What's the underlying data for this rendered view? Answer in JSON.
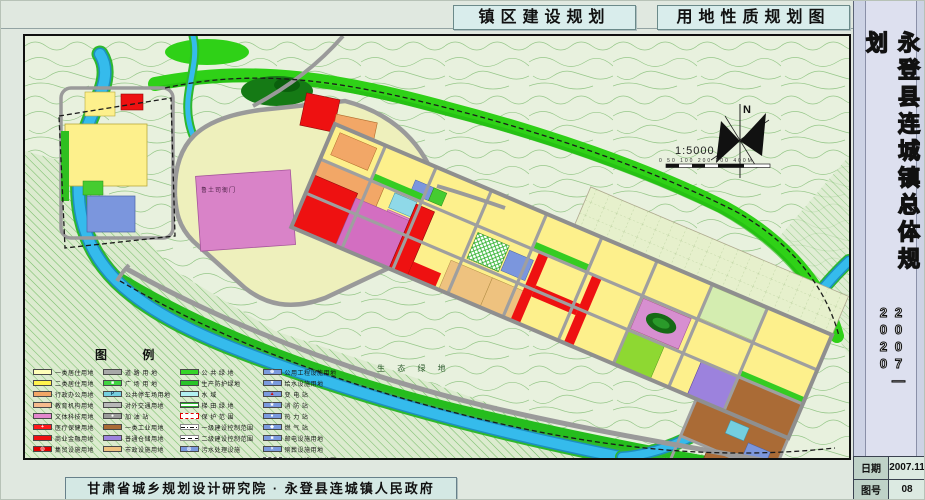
{
  "titles": {
    "left": "镇区建设规划",
    "right": "用地性质规划图"
  },
  "sidebar": {
    "title_vertical": "永登县连城镇总体规划",
    "period": "2007—2020",
    "date_label": "日期",
    "date_value": "2007.11",
    "sheet_label": "图号",
    "sheet_value": "08"
  },
  "footer": {
    "attribution": "甘肃省城乡规划设计研究院 · 永登县连城镇人民政府"
  },
  "map": {
    "north_label": "N",
    "scale_text": "1:5000",
    "scale_ticks": "0 50 100 200 300 400M",
    "labels": {
      "heritage": "鲁土司衙门",
      "eco_green": "生 态 绿 地"
    },
    "legend": {
      "title": "图  例",
      "columns": [
        {
          "items": [
            {
              "label": "一类居住用地",
              "color": "#ffffb8"
            },
            {
              "label": "二类居住用地",
              "color": "#fff34d"
            },
            {
              "label": "行政办公用地",
              "color": "#f2a767"
            },
            {
              "label": "教育机构用地",
              "color": "#f6bb8d"
            },
            {
              "label": "文体科技用地",
              "color": "#e387cd"
            },
            {
              "label": "医疗保健用地",
              "color": "#ff1a1a",
              "glyph": "+",
              "glyphColor": "#ffffff"
            },
            {
              "label": "商业金融用地",
              "color": "#ee1111"
            },
            {
              "label": "集贸设施用地",
              "color": "#e00000",
              "glyph": "◎",
              "glyphColor": "#ffffff"
            }
          ]
        },
        {
          "items": [
            {
              "label": "道 路 用 地",
              "color": "#a8a8a8"
            },
            {
              "label": "广 场 用 地",
              "color": "#3fd43f",
              "glyph": "■",
              "glyphColor": "#ffffff"
            },
            {
              "label": "公共停车场用地",
              "color": "#74cfe0",
              "glyph": "P",
              "glyphColor": "#103a5a"
            },
            {
              "label": "对外交通用地",
              "color": "#b8b8b8"
            },
            {
              "label": "加 油 站",
              "color": "#9a9a9a",
              "glyph": "●",
              "glyphColor": "#ffffff"
            },
            {
              "label": "一类工业用地",
              "color": "#aa6b36"
            },
            {
              "label": "普通仓储用地",
              "color": "#9c82dd"
            },
            {
              "label": "市政设施用地",
              "color": "#eec27f"
            }
          ]
        },
        {
          "items": [
            {
              "label": "公 共 绿 地",
              "color": "#35d527"
            },
            {
              "label": "生产防护绿地",
              "color": "#28c428"
            },
            {
              "label": "水    域",
              "color": "#b2f0f2"
            },
            {
              "label": "梯 田 绿 地",
              "color": "#ffffff",
              "style": "lines-green"
            },
            {
              "label": "保 护 范 围",
              "color": "#ffffff",
              "style": "dashed-red"
            },
            {
              "label": "一级建设控制范围",
              "color": "#ffffff",
              "style": "dash-dot"
            },
            {
              "label": "二级建设控制范围",
              "color": "#ffffff",
              "style": "dashed-black"
            },
            {
              "label": "污水处理设施",
              "color": "#7b9ade",
              "glyph": "◎",
              "glyphColor": "#ffffff"
            }
          ]
        },
        {
          "items": [
            {
              "label": "公用工程设施用地",
              "color": "#7b9ade",
              "glyph": "⊕",
              "glyphColor": "#ffffff"
            },
            {
              "label": "给水设施用地",
              "color": "#7b9ade",
              "glyph": "▼",
              "glyphColor": "#ffffff"
            },
            {
              "label": "变 电 站",
              "color": "#7b9ade",
              "glyph": "▲",
              "glyphColor": "#d01010"
            },
            {
              "label": "消 防 站",
              "color": "#7b9ade",
              "glyph": "★",
              "glyphColor": "#ffffff"
            },
            {
              "label": "热 力 站",
              "color": "#7b9ade",
              "glyph": "●",
              "glyphColor": "#ffffff"
            },
            {
              "label": "燃 气 站",
              "color": "#7b9ade",
              "glyph": "◆",
              "glyphColor": "#ffffff"
            },
            {
              "label": "邮电设施用地",
              "color": "#7b9ade",
              "glyph": "■",
              "glyphColor": "#ffffff"
            },
            {
              "label": "殡葬设施用地",
              "color": "#7b9ade",
              "glyph": "×",
              "glyphColor": "#ffffff"
            },
            {
              "label": "村庄建设用地范围",
              "color": "#f5f5ef",
              "style": "dashed-gray"
            }
          ]
        }
      ]
    }
  }
}
